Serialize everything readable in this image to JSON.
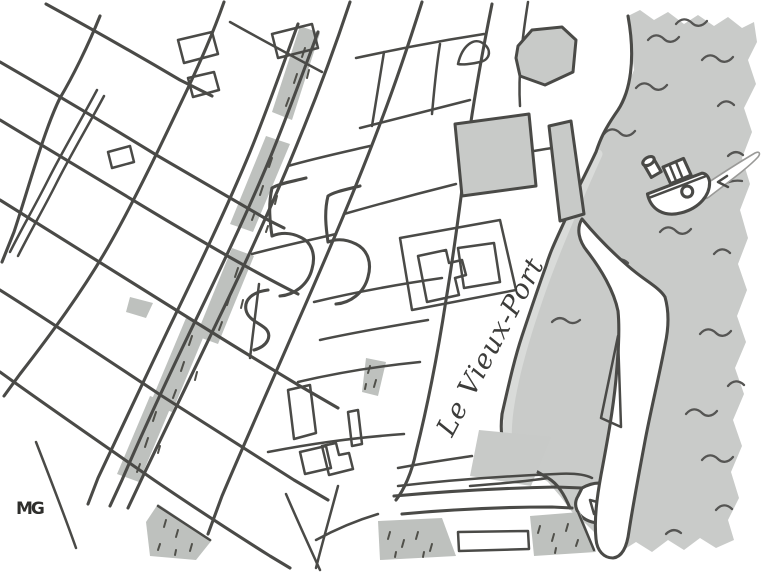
{
  "artwork": {
    "port_label": "Le Vieux-Port",
    "artist_signature": "MG",
    "icons": {
      "boat_icon": "small tugboat with smokestack, porthole and white wake",
      "wave_marks": "short wavy pen strokes on the harbor water",
      "stippled_blocks": "gray blocks speckled with short dashes (tree-lined squares)"
    },
    "colors": {
      "paper": "#ffffff",
      "water": "#c9cbc9",
      "building": "#c8cac8",
      "tree_block": "#bec1be",
      "ink": "#4a4a47",
      "stipple": "#50504a",
      "pencil": "#d9dbd9",
      "wake_outline": "#9a9a98"
    }
  }
}
